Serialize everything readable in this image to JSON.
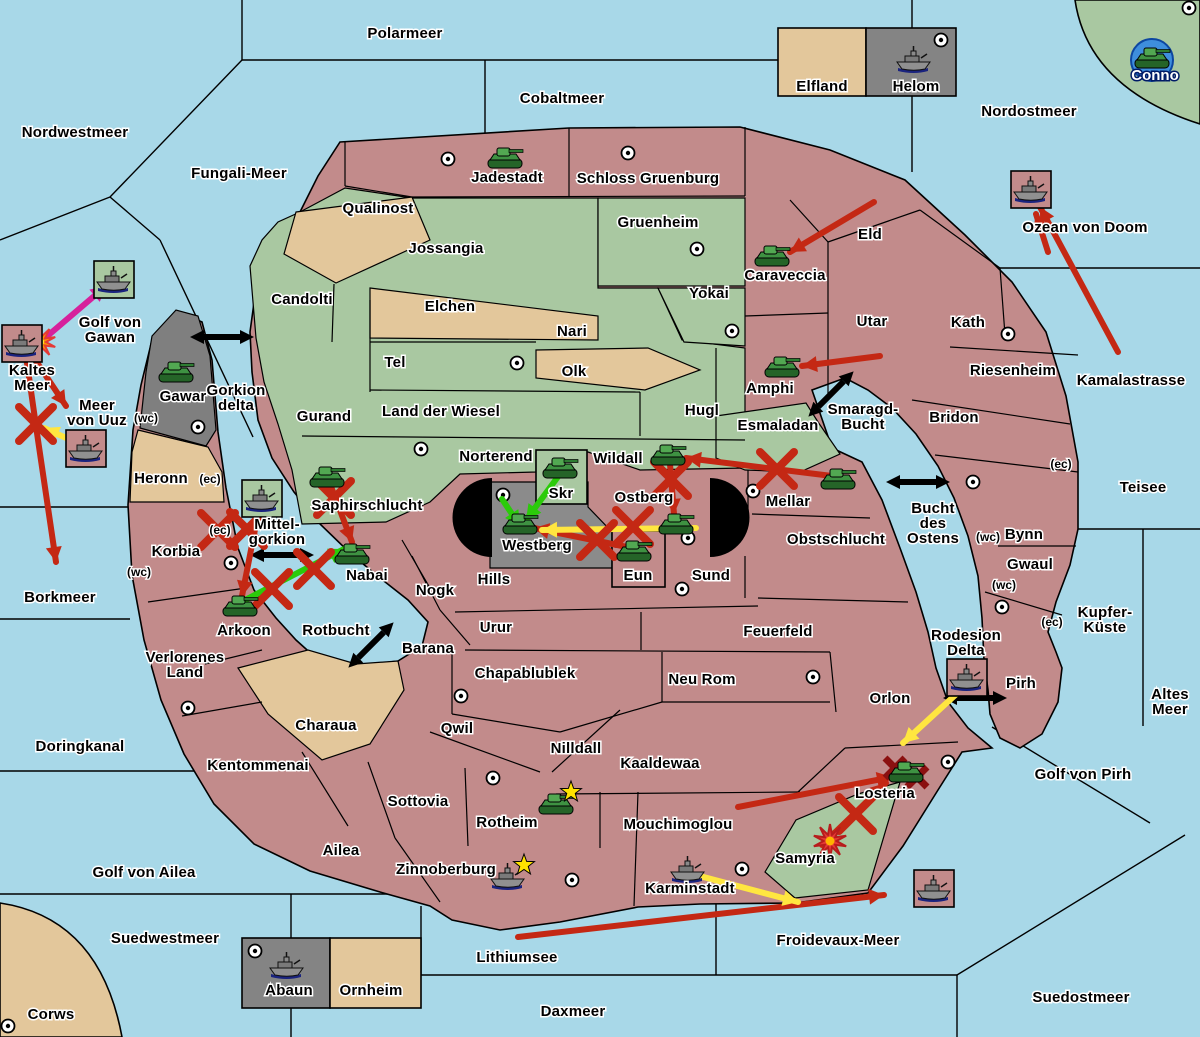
{
  "colors": {
    "sea": "#A8D8E8",
    "land": "#C28B8B",
    "green": "#A9C8A1",
    "tan": "#E3C79B",
    "gray": "#7F7F7F",
    "gray_box": "#848484",
    "black": "#000000",
    "arrow_red": "#C42814",
    "arrow_green": "#2BCB0A",
    "arrow_yellow": "#FFE640",
    "arrow_magenta": "#D6219C",
    "battle_red": "#8B1010",
    "conno_circle": "#3E8EDD"
  },
  "sea_labels": [
    {
      "id": "nordwestmeer",
      "text": "Nordwestmeer",
      "x": 75,
      "y": 137
    },
    {
      "id": "polarmeer",
      "text": "Polarmeer",
      "x": 405,
      "y": 38
    },
    {
      "id": "cobaltmeer",
      "text": "Cobaltmeer",
      "x": 562,
      "y": 103
    },
    {
      "id": "nordostmeer",
      "text": "Nordostmeer",
      "x": 1029,
      "y": 116
    },
    {
      "id": "fungali-meer",
      "text": "Fungali-Meer",
      "x": 239,
      "y": 178
    },
    {
      "id": "ozean-von-doom",
      "text": "Ozean von Doom",
      "x": 1085,
      "y": 232
    },
    {
      "id": "kamalastrasse",
      "text": "Kamalastrasse",
      "x": 1131,
      "y": 385
    },
    {
      "id": "golf-von-gawan",
      "text": "Golf von\nGawan",
      "x": 110,
      "y": 327
    },
    {
      "id": "kaltes-meer",
      "text": "Kaltes\nMeer",
      "x": 32,
      "y": 375
    },
    {
      "id": "meer-von-uuz",
      "text": "Meer\nvon Uuz",
      "x": 97,
      "y": 410
    },
    {
      "id": "gorkion-delta",
      "text": "Gorkion\ndelta",
      "x": 236,
      "y": 395
    },
    {
      "id": "mittel-gorkion",
      "text": "Mittel-\ngorkion",
      "x": 277,
      "y": 529
    },
    {
      "id": "borkmeer",
      "text": "Borkmeer",
      "x": 60,
      "y": 602
    },
    {
      "id": "rotbucht",
      "text": "Rotbucht",
      "x": 336,
      "y": 635
    },
    {
      "id": "doringkanal",
      "text": "Doringkanal",
      "x": 80,
      "y": 751
    },
    {
      "id": "golf-von-ailea",
      "text": "Golf von Ailea",
      "x": 144,
      "y": 877
    },
    {
      "id": "suedwestmeer",
      "text": "Suedwestmeer",
      "x": 165,
      "y": 943
    },
    {
      "id": "lithiumsee",
      "text": "Lithiumsee",
      "x": 517,
      "y": 962
    },
    {
      "id": "daxmeer",
      "text": "Daxmeer",
      "x": 573,
      "y": 1016
    },
    {
      "id": "froidevaux-meer",
      "text": "Froidevaux-Meer",
      "x": 838,
      "y": 945
    },
    {
      "id": "suedostmeer",
      "text": "Suedostmeer",
      "x": 1081,
      "y": 1002
    },
    {
      "id": "teisee",
      "text": "Teisee",
      "x": 1143,
      "y": 492
    },
    {
      "id": "kupfer-kueste",
      "text": "Kupfer-\nKüste",
      "x": 1105,
      "y": 617
    },
    {
      "id": "altes-meer",
      "text": "Altes\nMeer",
      "x": 1170,
      "y": 699
    },
    {
      "id": "golf-von-pirh",
      "text": "Golf von Pirh",
      "x": 1083,
      "y": 779
    },
    {
      "id": "smaragd-bucht",
      "text": "Smaragd-\nBucht",
      "x": 863,
      "y": 414
    },
    {
      "id": "bucht-des-ostens",
      "text": "Bucht\ndes\nOstens",
      "x": 933,
      "y": 513
    },
    {
      "id": "rodesion-delta",
      "text": "Rodesion\nDelta",
      "x": 966,
      "y": 640
    }
  ],
  "region_labels": [
    {
      "id": "elfland",
      "text": "Elfland",
      "x": 822,
      "y": 91
    },
    {
      "id": "helom",
      "text": "Helom",
      "x": 916,
      "y": 91
    },
    {
      "id": "qualinost",
      "text": "Qualinost",
      "x": 378,
      "y": 213
    },
    {
      "id": "jadestadt",
      "text": "Jadestadt",
      "x": 507,
      "y": 182
    },
    {
      "id": "schloss-gruenburg",
      "text": "Schloss Gruenburg",
      "x": 648,
      "y": 183
    },
    {
      "id": "gruenheim",
      "text": "Gruenheim",
      "x": 658,
      "y": 227
    },
    {
      "id": "jossangia",
      "text": "Jossangia",
      "x": 446,
      "y": 253
    },
    {
      "id": "candolti",
      "text": "Candolti",
      "x": 302,
      "y": 304
    },
    {
      "id": "elchen",
      "text": "Elchen",
      "x": 450,
      "y": 311
    },
    {
      "id": "nari",
      "text": "Nari",
      "x": 572,
      "y": 336
    },
    {
      "id": "yokai",
      "text": "Yokai",
      "x": 709,
      "y": 298
    },
    {
      "id": "caraveccia",
      "text": "Caraveccia",
      "x": 785,
      "y": 280
    },
    {
      "id": "eld",
      "text": "Eld",
      "x": 870,
      "y": 239
    },
    {
      "id": "utar",
      "text": "Utar",
      "x": 872,
      "y": 326
    },
    {
      "id": "kath",
      "text": "Kath",
      "x": 968,
      "y": 327
    },
    {
      "id": "riesenheim",
      "text": "Riesenheim",
      "x": 1013,
      "y": 375
    },
    {
      "id": "bridon",
      "text": "Bridon",
      "x": 954,
      "y": 422
    },
    {
      "id": "amphi",
      "text": "Amphi",
      "x": 770,
      "y": 393
    },
    {
      "id": "esmaladan",
      "text": "Esmaladan",
      "x": 778,
      "y": 430
    },
    {
      "id": "tel",
      "text": "Tel",
      "x": 395,
      "y": 367
    },
    {
      "id": "olk",
      "text": "Olk",
      "x": 574,
      "y": 376
    },
    {
      "id": "gurand",
      "text": "Gurand",
      "x": 324,
      "y": 421
    },
    {
      "id": "land-der-wiesel",
      "text": "Land der Wiesel",
      "x": 441,
      "y": 416
    },
    {
      "id": "hugl",
      "text": "Hugl",
      "x": 702,
      "y": 415
    },
    {
      "id": "norterend",
      "text": "Norterend",
      "x": 496,
      "y": 461
    },
    {
      "id": "wildall",
      "text": "Wildall",
      "x": 618,
      "y": 463
    },
    {
      "id": "skr",
      "text": "Skr",
      "x": 561,
      "y": 498
    },
    {
      "id": "ostberg",
      "text": "Ostberg",
      "x": 644,
      "y": 502
    },
    {
      "id": "mellar",
      "text": "Mellar",
      "x": 788,
      "y": 506
    },
    {
      "id": "westberg",
      "text": "Westberg",
      "x": 537,
      "y": 550
    },
    {
      "id": "eun",
      "text": "Eun",
      "x": 638,
      "y": 580
    },
    {
      "id": "sund",
      "text": "Sund",
      "x": 711,
      "y": 580
    },
    {
      "id": "obstschlucht",
      "text": "Obstschlucht",
      "x": 836,
      "y": 544
    },
    {
      "id": "hills",
      "text": "Hills",
      "x": 494,
      "y": 584
    },
    {
      "id": "nogk",
      "text": "Nogk",
      "x": 435,
      "y": 595
    },
    {
      "id": "gawar",
      "text": "Gawar",
      "x": 183,
      "y": 401
    },
    {
      "id": "heronn",
      "text": "Heronn",
      "x": 161,
      "y": 483
    },
    {
      "id": "korbia",
      "text": "Korbia",
      "x": 176,
      "y": 556
    },
    {
      "id": "saphirschlucht",
      "text": "Saphirschlucht",
      "x": 367,
      "y": 510
    },
    {
      "id": "nabai",
      "text": "Nabai",
      "x": 367,
      "y": 580
    },
    {
      "id": "arkoon",
      "text": "Arkoon",
      "x": 244,
      "y": 635
    },
    {
      "id": "verlorenes-land",
      "text": "Verlorenes\nLand",
      "x": 185,
      "y": 662
    },
    {
      "id": "barana",
      "text": "Barana",
      "x": 428,
      "y": 653
    },
    {
      "id": "urur",
      "text": "Urur",
      "x": 496,
      "y": 632
    },
    {
      "id": "feuerfeld",
      "text": "Feuerfeld",
      "x": 778,
      "y": 636
    },
    {
      "id": "chapablublek",
      "text": "Chapablublek",
      "x": 525,
      "y": 678
    },
    {
      "id": "neu-rom",
      "text": "Neu Rom",
      "x": 702,
      "y": 684
    },
    {
      "id": "qwil",
      "text": "Qwil",
      "x": 457,
      "y": 733
    },
    {
      "id": "nilldall",
      "text": "Nilldall",
      "x": 576,
      "y": 753
    },
    {
      "id": "kaaldewaa",
      "text": "Kaaldewaa",
      "x": 660,
      "y": 768
    },
    {
      "id": "charaua",
      "text": "Charaua",
      "x": 326,
      "y": 730
    },
    {
      "id": "kentommenai",
      "text": "Kentommenai",
      "x": 258,
      "y": 770
    },
    {
      "id": "sottovia",
      "text": "Sottovia",
      "x": 418,
      "y": 806
    },
    {
      "id": "rotheim",
      "text": "Rotheim",
      "x": 507,
      "y": 827
    },
    {
      "id": "mouchimoglou",
      "text": "Mouchimoglou",
      "x": 678,
      "y": 829
    },
    {
      "id": "ailea",
      "text": "Ailea",
      "x": 341,
      "y": 855
    },
    {
      "id": "zinnoberburg",
      "text": "Zinnoberburg",
      "x": 446,
      "y": 874
    },
    {
      "id": "karminstadt",
      "text": "Karminstadt",
      "x": 690,
      "y": 893
    },
    {
      "id": "samyria",
      "text": "Samyria",
      "x": 805,
      "y": 863
    },
    {
      "id": "losteria",
      "text": "Losteria",
      "x": 885,
      "y": 798
    },
    {
      "id": "orlon",
      "text": "Orlon",
      "x": 890,
      "y": 703
    },
    {
      "id": "pirh",
      "text": "Pirh",
      "x": 1021,
      "y": 688
    },
    {
      "id": "bynn",
      "text": "Bynn",
      "x": 1024,
      "y": 539
    },
    {
      "id": "gwaul",
      "text": "Gwaul",
      "x": 1030,
      "y": 569
    },
    {
      "id": "abaun",
      "text": "Abaun",
      "x": 289,
      "y": 995
    },
    {
      "id": "ornheim",
      "text": "Ornheim",
      "x": 371,
      "y": 995
    },
    {
      "id": "corws",
      "text": "Corws",
      "x": 51,
      "y": 1019
    },
    {
      "id": "conno",
      "text": "Conno",
      "x": 1155,
      "y": 80,
      "white": true
    }
  ],
  "coast_markers": [
    {
      "text": "(wc)",
      "x": 146,
      "y": 422
    },
    {
      "text": "(ec)",
      "x": 210,
      "y": 483
    },
    {
      "text": "(ec)",
      "x": 220,
      "y": 534
    },
    {
      "text": "(wc)",
      "x": 139,
      "y": 576
    },
    {
      "text": "(ec)",
      "x": 1061,
      "y": 468
    },
    {
      "text": "(wc)",
      "x": 988,
      "y": 541
    },
    {
      "text": "(wc)",
      "x": 1004,
      "y": 589
    },
    {
      "text": "(ec)",
      "x": 1052,
      "y": 626
    }
  ],
  "supply_centers": [
    [
      448,
      159
    ],
    [
      628,
      153
    ],
    [
      697,
      249
    ],
    [
      732,
      331
    ],
    [
      517,
      363
    ],
    [
      421,
      449
    ],
    [
      941,
      40
    ],
    [
      1189,
      8
    ],
    [
      198,
      427
    ],
    [
      231,
      563
    ],
    [
      188,
      708
    ],
    [
      493,
      778
    ],
    [
      572,
      880
    ],
    [
      742,
      869
    ],
    [
      948,
      762
    ],
    [
      461,
      696
    ],
    [
      813,
      677
    ],
    [
      753,
      491
    ],
    [
      688,
      538
    ],
    [
      682,
      589
    ],
    [
      503,
      495
    ],
    [
      973,
      482
    ],
    [
      1002,
      607
    ],
    [
      1008,
      334
    ],
    [
      8,
      1026
    ],
    [
      255,
      951
    ]
  ],
  "units": [
    {
      "type": "army",
      "region": "jadestadt",
      "x": 505,
      "y": 158
    },
    {
      "type": "army",
      "region": "conno",
      "x": 1152,
      "y": 58,
      "circle": true
    },
    {
      "type": "army",
      "region": "gawar",
      "x": 176,
      "y": 372
    },
    {
      "type": "army",
      "region": "caraveccia",
      "x": 772,
      "y": 256
    },
    {
      "type": "army",
      "region": "amphi",
      "x": 782,
      "y": 367
    },
    {
      "type": "army",
      "region": "saphirschlucht",
      "x": 327,
      "y": 477
    },
    {
      "type": "army",
      "region": "nabai",
      "x": 352,
      "y": 554
    },
    {
      "type": "army",
      "region": "arkoon",
      "x": 240,
      "y": 606
    },
    {
      "type": "army",
      "region": "skr",
      "x": 560,
      "y": 468
    },
    {
      "type": "army",
      "region": "westberg",
      "x": 520,
      "y": 524
    },
    {
      "type": "army",
      "region": "wildall",
      "x": 668,
      "y": 455
    },
    {
      "type": "army",
      "region": "ostberg",
      "x": 676,
      "y": 524
    },
    {
      "type": "army",
      "region": "eun",
      "x": 634,
      "y": 551
    },
    {
      "type": "army",
      "region": "mellar",
      "x": 838,
      "y": 479
    },
    {
      "type": "army",
      "region": "rotheim",
      "x": 556,
      "y": 804
    },
    {
      "type": "army",
      "region": "losteria",
      "x": 906,
      "y": 772
    },
    {
      "type": "fleet",
      "region": "helom",
      "x": 914,
      "y": 60
    },
    {
      "type": "fleet",
      "region": "zinnoberburg",
      "x": 508,
      "y": 877
    },
    {
      "type": "fleet",
      "region": "karminstadt",
      "x": 688,
      "y": 870
    },
    {
      "type": "fleet",
      "region": "kaltes-meer",
      "x": 22,
      "y": 344,
      "boxed": true,
      "box_fill": "land"
    },
    {
      "type": "fleet",
      "region": "golf-von-gawan",
      "x": 114,
      "y": 280,
      "boxed": true,
      "box_fill": "green"
    },
    {
      "type": "fleet",
      "region": "meer-von-uuz",
      "x": 86,
      "y": 449,
      "boxed": true,
      "box_fill": "land"
    },
    {
      "type": "fleet",
      "region": "mittel-gorkion",
      "x": 262,
      "y": 499,
      "boxed": true,
      "box_fill": "green"
    },
    {
      "type": "fleet",
      "region": "ozean-von-doom",
      "x": 1031,
      "y": 190,
      "boxed": true,
      "box_fill": "land"
    },
    {
      "type": "fleet",
      "region": "rodesion-delta",
      "x": 967,
      "y": 678,
      "boxed": true,
      "box_fill": "land"
    },
    {
      "type": "fleet",
      "region": "froidevaux-meer",
      "x": 934,
      "y": 889,
      "boxed": true,
      "box_fill": "land"
    },
    {
      "type": "fleet",
      "region": "abaun",
      "x": 287,
      "y": 966
    }
  ],
  "unit_stars": [
    [
      571,
      792
    ],
    [
      524,
      865
    ]
  ],
  "bursts": [
    {
      "x": 40,
      "y": 342,
      "style": "orange"
    },
    {
      "x": 830,
      "y": 841,
      "style": "red"
    }
  ],
  "battle_marks": [
    [
      895,
      768
    ],
    [
      917,
      777
    ]
  ],
  "strait_arrows": [
    {
      "x": 222,
      "y": 337,
      "angle": 0
    },
    {
      "x": 282,
      "y": 555,
      "angle": 0
    },
    {
      "x": 371,
      "y": 645,
      "angle": -45
    },
    {
      "x": 831,
      "y": 394,
      "angle": -45
    },
    {
      "x": 918,
      "y": 482,
      "angle": 0
    },
    {
      "x": 975,
      "y": 698,
      "angle": 0
    }
  ],
  "order_arrows": [
    {
      "color": "red",
      "pts": [
        [
          1118,
          352
        ],
        [
          1040,
          207
        ]
      ]
    },
    {
      "color": "red",
      "pts": [
        [
          1048,
          252
        ],
        [
          1036,
          214
        ]
      ]
    },
    {
      "color": "red",
      "pts": [
        [
          26,
          356
        ],
        [
          38,
          440
        ],
        [
          56,
          562
        ]
      ]
    },
    {
      "color": "red",
      "pts": [
        [
          30,
          352
        ],
        [
          66,
          406
        ]
      ]
    },
    {
      "color": "magenta",
      "pts": [
        [
          38,
          344
        ],
        [
          106,
          286
        ]
      ]
    },
    {
      "color": "red",
      "pts": [
        [
          874,
          202
        ],
        [
          790,
          252
        ]
      ]
    },
    {
      "color": "red",
      "pts": [
        [
          880,
          356
        ],
        [
          802,
          366
        ]
      ]
    },
    {
      "color": "red",
      "pts": [
        [
          832,
          476
        ],
        [
          686,
          458
        ]
      ]
    },
    {
      "color": "red",
      "pts": [
        [
          670,
          464
        ],
        [
          674,
          514
        ]
      ]
    },
    {
      "color": "red",
      "pts": [
        [
          632,
          548
        ],
        [
          534,
          528
        ]
      ]
    },
    {
      "color": "red",
      "pts": [
        [
          330,
          484
        ],
        [
          352,
          542
        ]
      ]
    },
    {
      "color": "red",
      "pts": [
        [
          258,
          514
        ],
        [
          242,
          596
        ]
      ]
    },
    {
      "color": "red",
      "pts": [
        [
          738,
          807
        ],
        [
          892,
          777
        ]
      ]
    },
    {
      "color": "red",
      "pts": [
        [
          822,
          845
        ],
        [
          886,
          783
        ]
      ]
    },
    {
      "color": "red",
      "pts": [
        [
          518,
          937
        ],
        [
          884,
          895
        ]
      ]
    },
    {
      "color": "green",
      "pts": [
        [
          560,
          474
        ],
        [
          526,
          520
        ]
      ]
    },
    {
      "color": "green",
      "pts": [
        [
          502,
          499
        ],
        [
          520,
          526
        ]
      ]
    },
    {
      "color": "green",
      "pts": [
        [
          243,
          601
        ],
        [
          344,
          549
        ]
      ]
    },
    {
      "color": "yellow",
      "pts": [
        [
          84,
          446
        ],
        [
          44,
          428
        ]
      ]
    },
    {
      "color": "yellow",
      "pts": [
        [
          696,
          528
        ],
        [
          542,
          530
        ]
      ]
    },
    {
      "color": "yellow",
      "pts": [
        [
          964,
          687
        ],
        [
          903,
          743
        ]
      ]
    },
    {
      "color": "yellow",
      "pts": [
        [
          696,
          875
        ],
        [
          798,
          902
        ]
      ]
    }
  ],
  "cut_marks": [
    [
      36,
      424
    ],
    [
      777,
      469
    ],
    [
      671,
      479
    ],
    [
      597,
      540
    ],
    [
      633,
      527
    ],
    [
      334,
      498
    ],
    [
      247,
      529
    ],
    [
      218,
      530
    ],
    [
      272,
      589
    ],
    [
      314,
      569
    ],
    [
      856,
      814
    ]
  ]
}
